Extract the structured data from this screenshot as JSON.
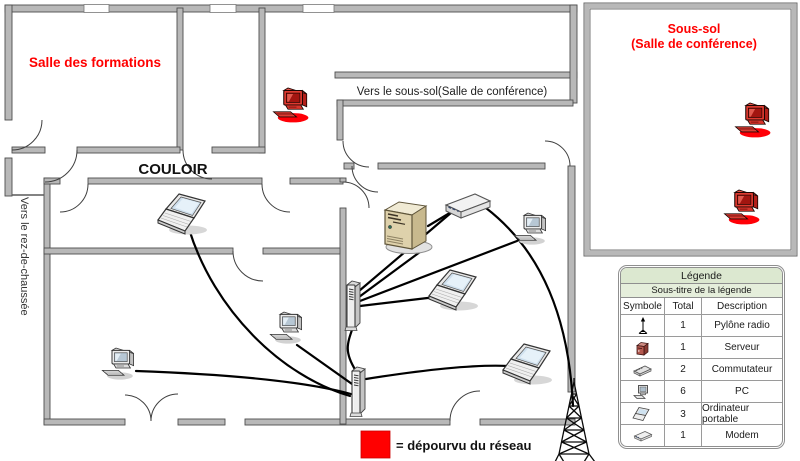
{
  "plan": {
    "salle_formations": "Salle des formations",
    "couloir": "COULOIR",
    "vers_rez": "Vers le rez-de-chaussée",
    "vers_sous_sol": "Vers le sous-sol(Salle de conférence)",
    "sous_sol_1": "Sous-sol",
    "sous_sol_2": "(Salle de conférence)",
    "no_network_label": "= dépourvu du réseau"
  },
  "colors": {
    "room_label_red": "#ff0000",
    "no_network_red": "#ff0000",
    "wall_gray": "#b8b8b8",
    "legend_header_green": "#dce8d0",
    "line_black": "#000000"
  },
  "legend": {
    "title": "Légende",
    "subtitle": "Sous-titre de la légende",
    "col_symbol": "Symbole",
    "col_total": "Total",
    "col_description": "Description",
    "rows": [
      {
        "symbol": "radio-mast-icon",
        "total": "1",
        "description": "Pylône radio"
      },
      {
        "symbol": "server-icon",
        "total": "1",
        "description": "Serveur"
      },
      {
        "symbol": "switch-icon",
        "total": "2",
        "description": "Commutateur"
      },
      {
        "symbol": "pc-icon",
        "total": "6",
        "description": "PC"
      },
      {
        "symbol": "laptop-icon",
        "total": "3",
        "description": "Ordinateur portable"
      },
      {
        "symbol": "modem-icon",
        "total": "1",
        "description": "Modem"
      }
    ]
  }
}
